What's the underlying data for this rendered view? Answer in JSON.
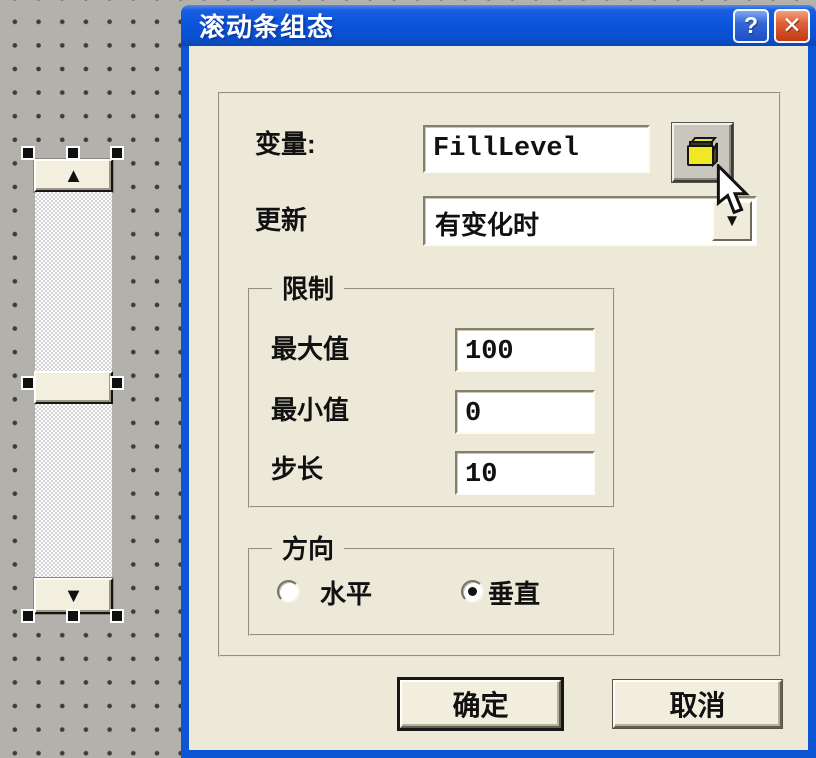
{
  "colors": {
    "titlebar_blue": "#0b54d8",
    "close_red": "#d5502b",
    "dialog_face": "#ece9d8",
    "canvas_gray": "#b3b1ac",
    "folder_yellow": "#f0e822"
  },
  "canvas": {
    "widget": "vertical-scrollbar",
    "icons": {
      "up_arrow": "▲",
      "down_arrow": "▼"
    }
  },
  "dialog": {
    "title": "滚动条组态",
    "titlebar": {
      "help": "?",
      "close": "✕"
    },
    "variable": {
      "label": "变量:",
      "value": "FillLevel"
    },
    "update": {
      "label": "更新",
      "value": "有变化时",
      "dropdown_arrow": "▼"
    },
    "limits_group": {
      "title": "限制",
      "rows": [
        {
          "label": "最大值",
          "value": "100"
        },
        {
          "label": "最小值",
          "value": "0"
        },
        {
          "label": "步长",
          "value": "10"
        }
      ]
    },
    "direction_group": {
      "title": "方向",
      "options": [
        {
          "label": "水平",
          "selected": false
        },
        {
          "label": "垂直",
          "selected": true
        }
      ]
    },
    "buttons": {
      "ok": "确定",
      "cancel": "取消"
    }
  }
}
